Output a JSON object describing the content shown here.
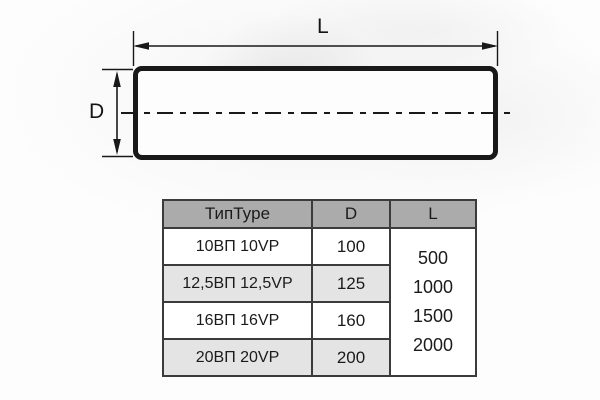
{
  "diagram": {
    "length_label": "L",
    "diameter_label": "D"
  },
  "table": {
    "headers": [
      "ТипType",
      "D",
      "L"
    ],
    "rows": [
      {
        "type": "10ВП 10VP",
        "d": "100"
      },
      {
        "type": "12,5ВП 12,5VP",
        "d": "125"
      },
      {
        "type": "16ВП 16VP",
        "d": "160"
      },
      {
        "type": "20ВП 20VP",
        "d": "200"
      }
    ],
    "l_values": [
      "500",
      "1000",
      "1500",
      "2000"
    ]
  },
  "colors": {
    "header_bg": "#ababab",
    "alt_row_bg": "#e4e4e4",
    "table_border": "#3b3b3b",
    "drawing_line": "#191919"
  }
}
